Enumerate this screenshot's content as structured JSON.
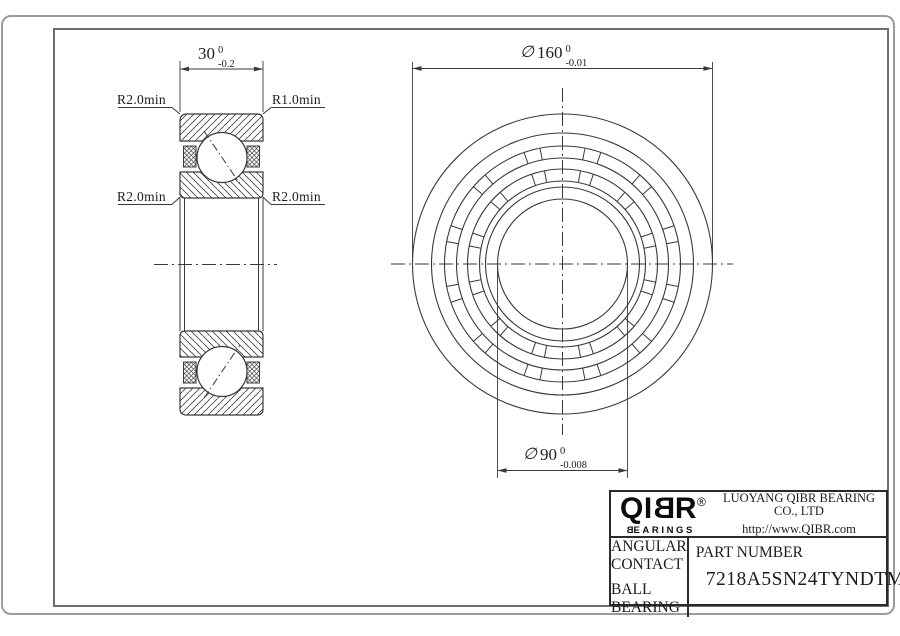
{
  "colors": {
    "line": "#3a3a3a",
    "drawing_frame": "#6e6e6e",
    "page_border": "#9b9b9b",
    "title_border": "#2a2a2a"
  },
  "dimensions": {
    "width": {
      "value": "30",
      "tol_upper": "0",
      "tol_lower": "-0.2"
    },
    "outer_diameter": {
      "symbol": "∅",
      "value": "160",
      "tol_upper": "0",
      "tol_lower": "-0.01"
    },
    "bore_diameter": {
      "symbol": "∅",
      "value": "90",
      "tol_upper": "0",
      "tol_lower": "-0.008"
    }
  },
  "radius_labels": {
    "top_left": "R2.0min",
    "top_right": "R1.0min",
    "mid_left": "R2.0min",
    "mid_right": "R2.0min"
  },
  "title_block": {
    "logo_prefix": "QI",
    "logo_mirrored": "B",
    "logo_suffix": "R",
    "registered_mark": "®",
    "logo_sub_mirrored": "B",
    "logo_sub_rest": "EARINGS",
    "company": "LUOYANG QIBR BEARING CO., LTD",
    "website": "http://www.QIBR.com",
    "product_line1": "ANGULAR CONTACT",
    "product_line2": "BALL BEARING",
    "part_number_label": "PART NUMBER",
    "part_number": "7218A5SN24TYNDTMP4"
  }
}
